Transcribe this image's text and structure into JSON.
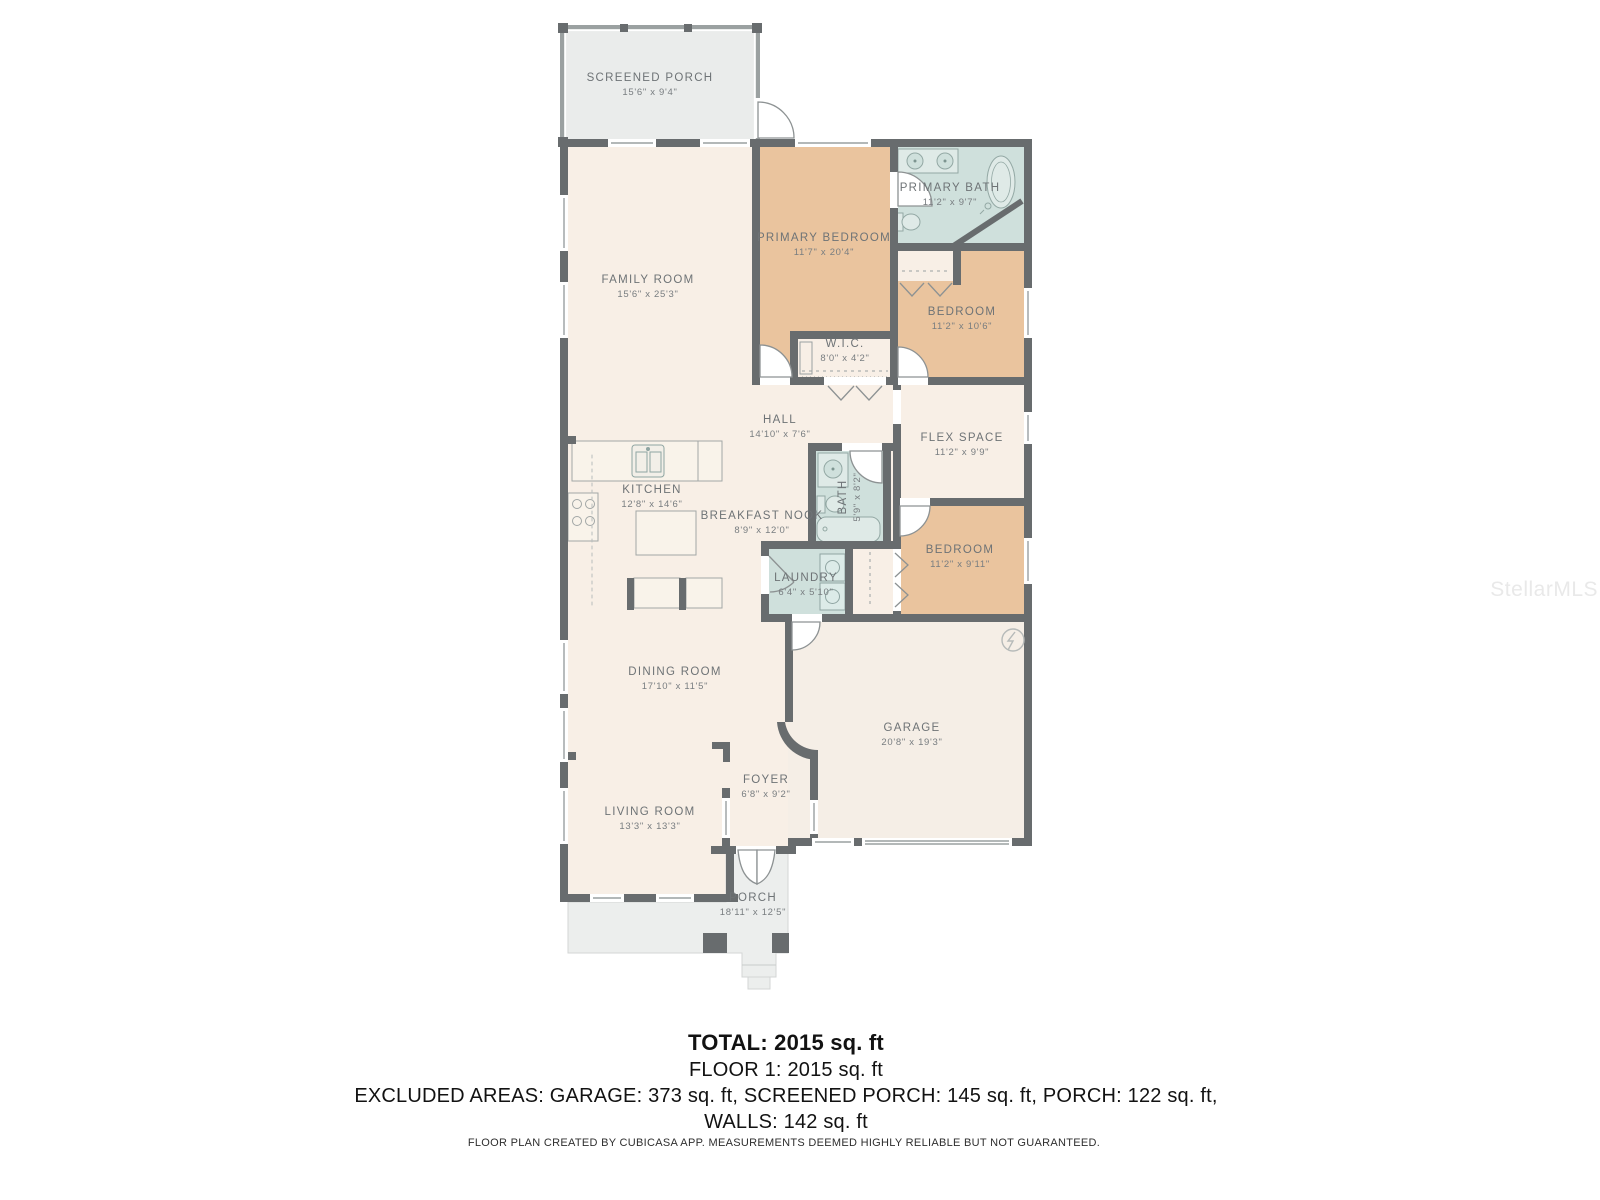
{
  "watermark": "StellarMLS",
  "rooms": {
    "screened_porch": {
      "name": "SCREENED PORCH",
      "dims": "15'6\" x 9'4\""
    },
    "family_room": {
      "name": "FAMILY ROOM",
      "dims": "15'6\" x 25'3\""
    },
    "primary_bedroom": {
      "name": "PRIMARY BEDROOM",
      "dims": "11'7\" x 20'4\""
    },
    "primary_bath": {
      "name": "PRIMARY BATH",
      "dims": "11'2\" x 9'7\""
    },
    "bedroom_top": {
      "name": "BEDROOM",
      "dims": "11'2\" x 10'6\""
    },
    "wic": {
      "name": "W.I.C.",
      "dims": "8'0\" x 4'2\""
    },
    "hall": {
      "name": "HALL",
      "dims": "14'10\" x 7'6\""
    },
    "flex_space": {
      "name": "FLEX SPACE",
      "dims": "11'2\" x 9'9\""
    },
    "kitchen": {
      "name": "KITCHEN",
      "dims": "12'8\" x 14'6\""
    },
    "breakfast_nook": {
      "name": "BREAKFAST NOOK",
      "dims": "8'9\" x 12'0\""
    },
    "bath": {
      "name": "BATH",
      "dims": "5'9\" x 8'2\""
    },
    "laundry": {
      "name": "LAUNDRY",
      "dims": "6'4\" x 5'10\""
    },
    "bedroom_mid": {
      "name": "BEDROOM",
      "dims": "11'2\" x 9'11\""
    },
    "dining_room": {
      "name": "DINING ROOM",
      "dims": "17'10\" x 11'5\""
    },
    "garage": {
      "name": "GARAGE",
      "dims": "20'8\" x 19'3\""
    },
    "foyer": {
      "name": "FOYER",
      "dims": "6'8\" x 9'2\""
    },
    "living_room": {
      "name": "LIVING ROOM",
      "dims": "13'3\" x 13'3\""
    },
    "porch": {
      "name": "PORCH",
      "dims": "18'11\" x 12'5\""
    }
  },
  "summary": {
    "total": "TOTAL: 2015 sq. ft",
    "floor": "FLOOR 1: 2015 sq. ft",
    "excluded": "EXCLUDED AREAS: GARAGE: 373 sq. ft, SCREENED PORCH: 145 sq. ft, PORCH: 122 sq. ft,",
    "walls": "WALLS: 142 sq. ft",
    "disclaimer": "FLOOR PLAN CREATED BY CUBICASA APP. MEASUREMENTS DEEMED HIGHLY RELIABLE BUT NOT GUARANTEED."
  },
  "colors": {
    "wall": "#686c6e",
    "room_cream": "#f8efe6",
    "room_tan": "#eac49e",
    "room_blue": "#cfe0dc",
    "garage_fill": "#f5eee6",
    "porch_gray": "#eceeed",
    "screen_porch_gray": "#eaeceb",
    "label_text": "#6e7376"
  }
}
